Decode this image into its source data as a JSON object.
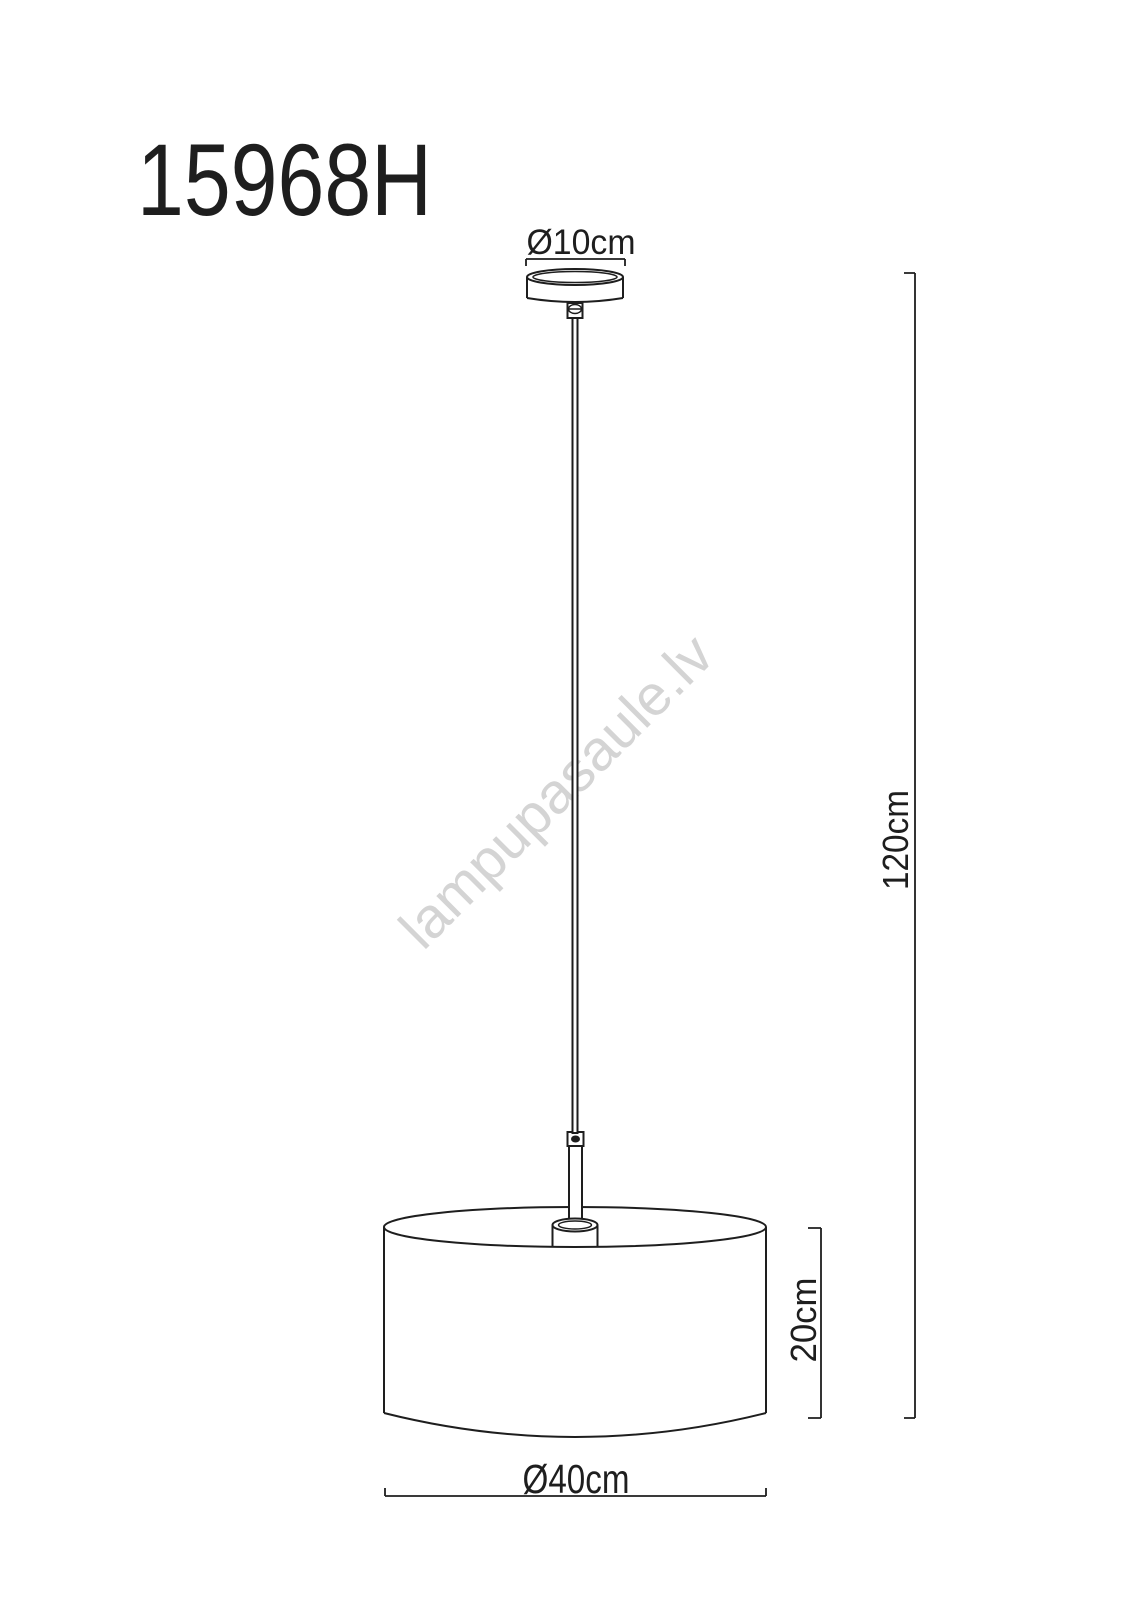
{
  "page": {
    "background": "#ffffff",
    "line_color": "#1e1e1e",
    "watermark_color": "#d4d4d4"
  },
  "title": "15968H",
  "watermark": "lampupasaule.lv",
  "diagram": {
    "type": "technical-drawing",
    "subject": "pendant-lamp-with-drum-shade",
    "dimensions": {
      "canopy_diameter": "Ø10cm",
      "total_height": "120cm",
      "shade_height": "20cm",
      "shade_diameter": "Ø40cm"
    }
  }
}
